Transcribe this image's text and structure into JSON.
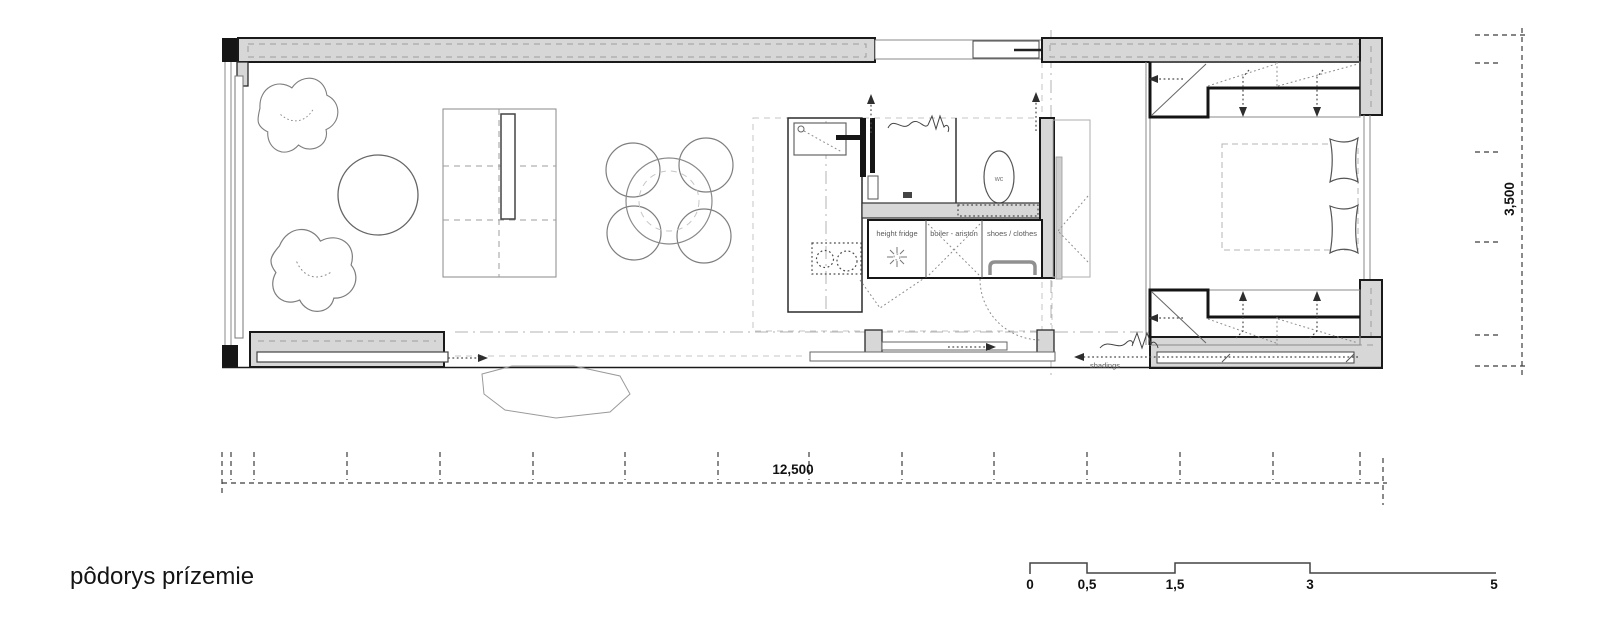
{
  "plan": {
    "title": "pôdorys prízemie",
    "rooms": {
      "wc_label": "wc",
      "cabinet_labels": [
        "height fridge",
        "boiler - ariston",
        "shoes / clothes"
      ],
      "shadings_label": "shadings"
    },
    "dimensions": {
      "width_label": "12,500",
      "height_label": "3,500"
    },
    "scale_bar": {
      "labels": [
        "0",
        "0,5",
        "1,5",
        "3",
        "5"
      ]
    },
    "colors": {
      "wall_fill": "#d7d7d7",
      "outline_black": "#1a1a1a",
      "line_gray": "#8a8a8a",
      "dash_gray": "#b3b3b3",
      "background": "#ffffff"
    }
  }
}
